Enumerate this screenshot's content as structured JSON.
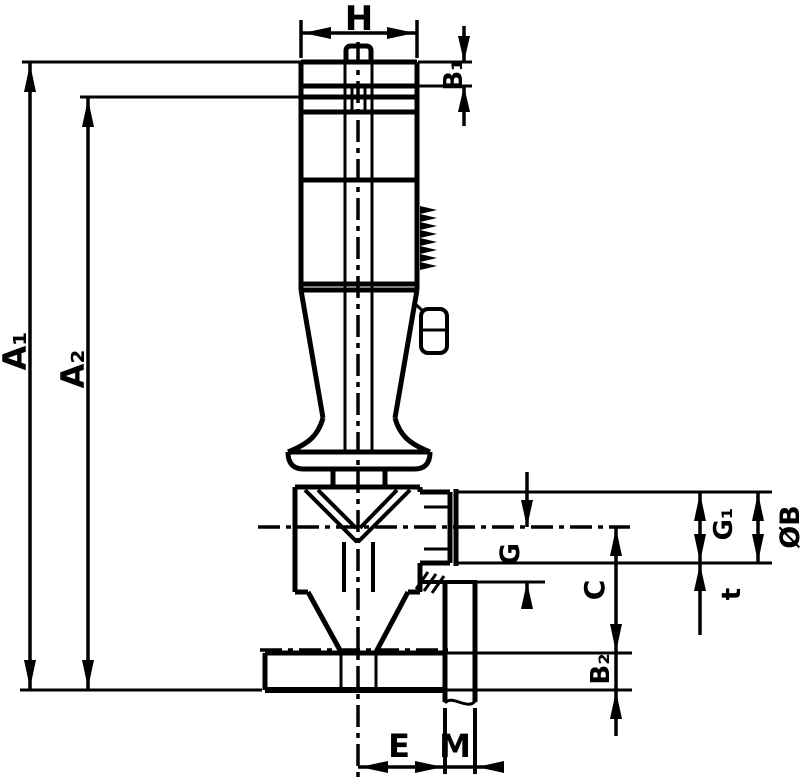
{
  "drawing": {
    "background": "#ffffff",
    "line_color": "#000000",
    "labels": {
      "H": "H",
      "A1": "A₁",
      "A2": "A₂",
      "B1": "B₁",
      "B2": "B₂",
      "G": "G",
      "G1": "G₁",
      "C": "C",
      "t": "t",
      "OB": "ØB",
      "E": "E",
      "M": "M"
    }
  }
}
